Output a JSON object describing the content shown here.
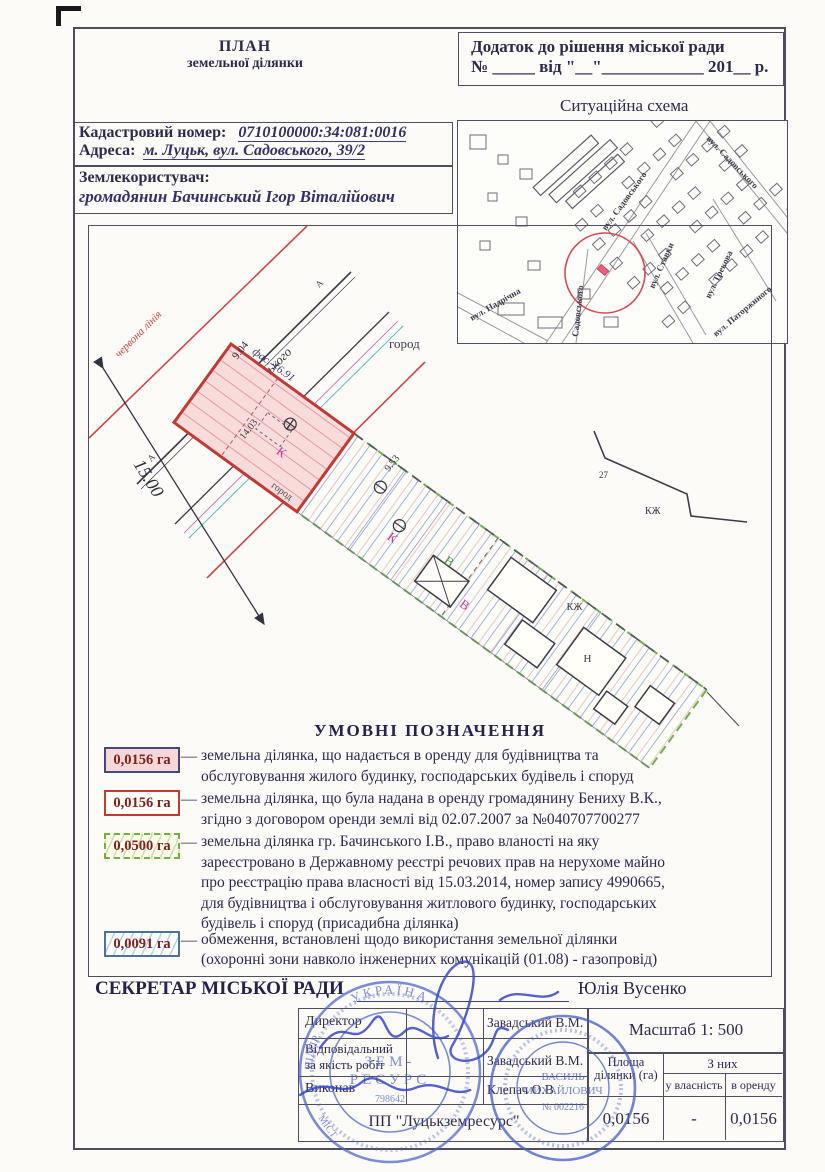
{
  "header": {
    "title_line1": "ПЛАН",
    "title_line2": "земельної ділянки",
    "annex_line1": "Додаток до рішення  міської ради",
    "annex_line2": "№ _____ від \"__\"____________ 201__ р.",
    "situational_schema_title": "Ситуаційна схема"
  },
  "info": {
    "cadastral_label": "Кадастровий номер:",
    "cadastral_value": "0710100000:34:081:0016",
    "address_label": "Адреса:",
    "address_value": "м. Луцьк, вул. Садовського, 39/2",
    "landuser_label": "Землекористувач:",
    "landuser_value": "громадянин Бачинський Ігор Віталійович"
  },
  "map": {
    "streets": {
      "nadrichna": "вул. Надрічна",
      "sadovskogo_vertical": "Садовського",
      "sadovskogo_main": "вул. Садовського",
      "sadovskogo_upper": "вул. Садовського",
      "stavky": "вул. Ставки",
      "trekova": "вул. Трекова",
      "patorzhynskogo": "вул. Паторжиного"
    }
  },
  "plan": {
    "red_line_label": "червона лінія",
    "street_label": "вул. Садовського",
    "width_dim": "15.00",
    "front_dim": "9.04",
    "facade_dim": "фас.-16.91",
    "side_dim": "14.03",
    "back_dim": "9.53",
    "garden_label": "город",
    "k_label": "К",
    "v_label": "В",
    "kzh_label": "КЖ",
    "n_label": "Н",
    "num_label": "27",
    "a_label": "А"
  },
  "legend": {
    "title": "УМОВНІ   ПОЗНАЧЕННЯ",
    "dash": "—",
    "items": [
      {
        "value": "0,0156 га",
        "text": "земельна ділянка, що надається в оренду для  будівництва та\nобслуговування жилого будинку, господарських будівель і споруд"
      },
      {
        "value": "0,0156 га",
        "text": "земельна ділянка, що була надана в оренду громадянину Бениху В.К.,\nзгідно з договором оренди землі від 02.07.2007 за №040707700277"
      },
      {
        "value": "0,0500 га",
        "text": "земельна ділянка гр. Бачинського І.В., право вланості на яку\nзареєстровано в Державному реєстрі речових прав на нерухоме майно\nпро реєстрацію права власності від 15.03.2014, номер запису  4990665,\nдля будівництва і обслуговування житлового будинку, господарських\nбудівель і споруд (присадибна ділянка)"
      },
      {
        "value": "0,0091 га",
        "text": "обмеження, встановлені щодо використання земельної ділянки\n(охоронні зони навколо інженерних комунікацій (01.08) - газопровід)"
      }
    ]
  },
  "secretary": {
    "label": "СЕКРЕТАР МІСЬКОЇ РАДИ",
    "name": "Юлія Вусенко"
  },
  "sign_table": {
    "rows": [
      {
        "role": "Директор",
        "name": "Завадський В.М."
      },
      {
        "role": "Відповідальний\nза якість робіт",
        "name": "Завадський В.М."
      },
      {
        "role": "Виконав",
        "name": "Клепач О.В"
      }
    ],
    "company": "ПП \"Луцькземресурс\""
  },
  "scale_block": {
    "scale_label": "Масштаб  1: 500",
    "area_col_header": "Площа ділянки (га)",
    "of_them_header": "З них",
    "ownership_header": "у власність",
    "lease_header": "в оренду",
    "area_value": "0,0156",
    "ownership_value": "-",
    "lease_value": "0,0156"
  },
  "stamps": {
    "round_seal": {
      "arc_top": "УКРАЇНА",
      "arc_left": "ПІДПР",
      "center_line1": "ЗЕМ-",
      "center_line2": "РЕСУРС",
      "number": "798642",
      "arc_bottom": "МІСТ"
    },
    "personal_seal": {
      "name_line1": "ВАСИЛЬ",
      "name_line2": "МИХАЙЛОВИЧ",
      "number": "№ 002216"
    }
  }
}
